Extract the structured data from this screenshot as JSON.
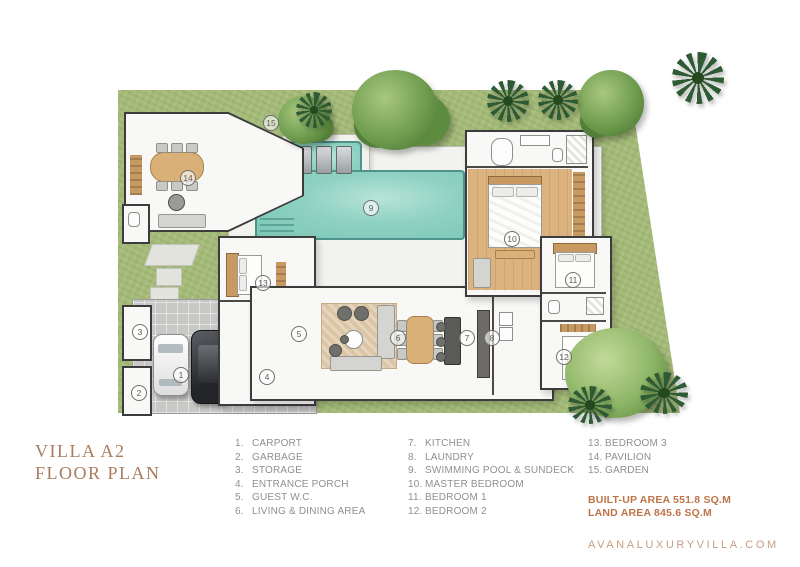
{
  "header": {
    "title_line1": "VILLA A2",
    "title_line2": "FLOOR PLAN"
  },
  "legend": {
    "col1": [
      {
        "num": "1.",
        "label": "CARPORT"
      },
      {
        "num": "2.",
        "label": "GARBAGE"
      },
      {
        "num": "3.",
        "label": "STORAGE"
      },
      {
        "num": "4.",
        "label": "ENTRANCE PORCH"
      },
      {
        "num": "5.",
        "label": "GUEST W.C."
      },
      {
        "num": "6.",
        "label": "LIVING & DINING AREA"
      }
    ],
    "col2": [
      {
        "num": "7.",
        "label": "KITCHEN"
      },
      {
        "num": "8.",
        "label": "LAUNDRY"
      },
      {
        "num": "9.",
        "label": "SWIMMING POOL & SUNDECK"
      },
      {
        "num": "10.",
        "label": "MASTER BEDROOM"
      },
      {
        "num": "11.",
        "label": "BEDROOM 1"
      },
      {
        "num": "12.",
        "label": "BEDROOM 2"
      }
    ],
    "col3": [
      {
        "num": "13.",
        "label": "BEDROOM 3"
      },
      {
        "num": "14.",
        "label": "PAVILION"
      },
      {
        "num": "15.",
        "label": "GARDEN"
      }
    ]
  },
  "areas": {
    "built_up": "BUILT-UP AREA 551.8 SQ.M",
    "land": "LAND AREA 845.6 SQ.M"
  },
  "website": "AVANALUXURYVILLA.COM",
  "plan": {
    "labels": [
      {
        "num": "1"
      },
      {
        "num": "2"
      },
      {
        "num": "3"
      },
      {
        "num": "4"
      },
      {
        "num": "5"
      },
      {
        "num": "6"
      },
      {
        "num": "7"
      },
      {
        "num": "8"
      },
      {
        "num": "9"
      },
      {
        "num": "10"
      },
      {
        "num": "11"
      },
      {
        "num": "12"
      },
      {
        "num": "13"
      },
      {
        "num": "14"
      },
      {
        "num": "15"
      }
    ]
  },
  "colors": {
    "title_text": "#aa7c5e",
    "legend_text": "#8d9092",
    "area_text": "#bd7448",
    "website_text": "#c79d80",
    "lawn": "#a4ba77",
    "pool": "#8ed1c1",
    "wood_floor": "#dcb27e",
    "wall": "#3c3c3c"
  }
}
